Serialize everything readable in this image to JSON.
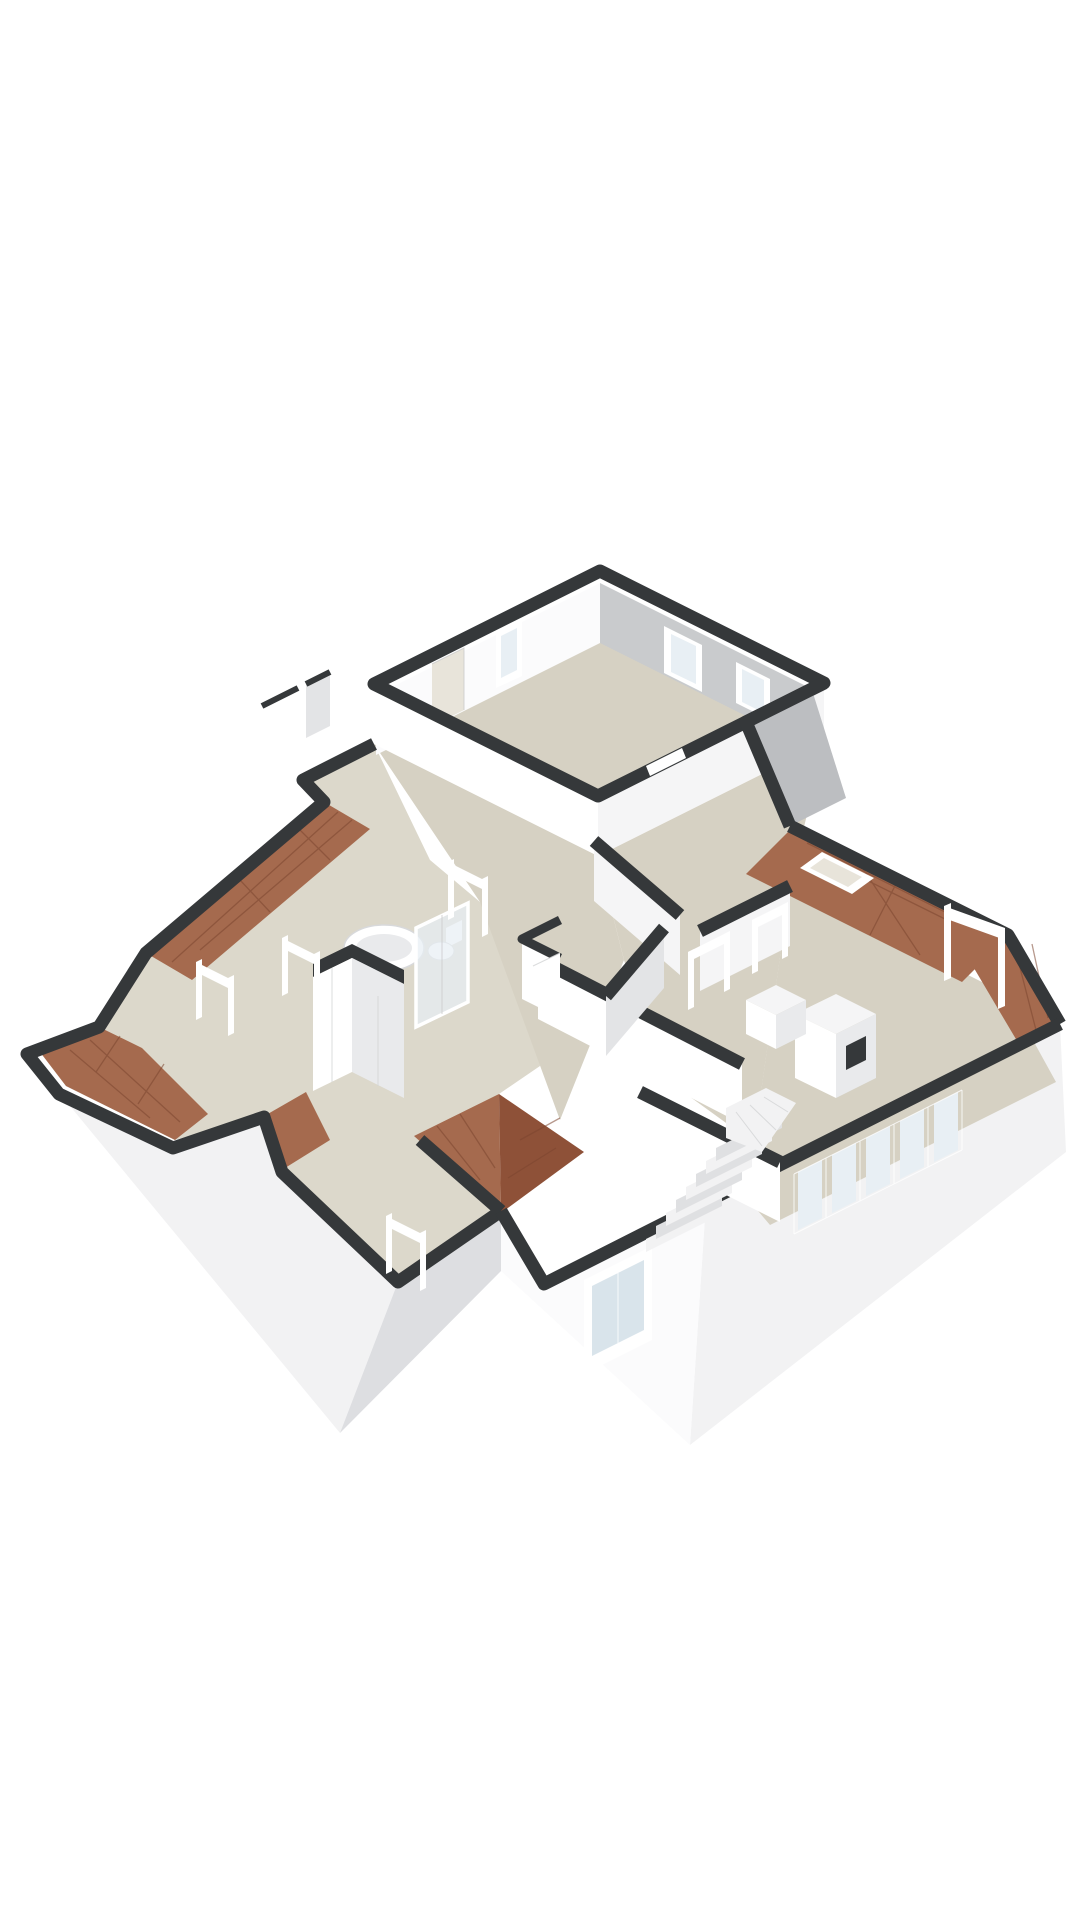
{
  "scene": {
    "type": "3d-floorplan-render",
    "view": "isometric",
    "storey": "attic floor with sloped roof sections",
    "background": "#ffffff"
  },
  "colors": {
    "wall_cap": "#35383a",
    "wall_cap_soft": "#45484a",
    "wall_white": "#ffffff",
    "wall_warm": "#fbfbfc",
    "wall_lit": "#f5f5f6",
    "wall_shade": "#e3e4e6",
    "wall_gray": "#c9cbcd",
    "wall_gray_deep": "#bcbec1",
    "ext_white": "#f2f2f3",
    "ext_shade": "#dddee1",
    "ext_shade_deep": "#d0d2d5",
    "floor": "#d6d1c3",
    "floor_light": "#dcd8cb",
    "floor_opening": "#e8e4da",
    "roof": "#a56a4e",
    "roof_dark": "#8e5138",
    "roof_line": "#7c452f",
    "glass": "#e8eff4",
    "glass_deep": "#d9e4eb",
    "frame": "#ffffff",
    "frame_line": "#c9c9cb",
    "fixture": "#ffffff",
    "fixture_shade": "#e9eaec",
    "fixture_line": "#d2d3d5",
    "step": "#f2f2f3",
    "step_shade": "#dfe0e2"
  },
  "objects": {
    "bedroom_large": "large room, top",
    "bedroom_right": "room with sloped roof edge, right",
    "bathroom": "bathtub, shower cabin, toilet, washbasin",
    "staircase": "winder staircase, bottom right",
    "wardrobe": "angled wardrobe block, centre left",
    "chimney": "chimney block with vent slot",
    "skylight": "roof window in tiled slope",
    "window_band": "five-part window band, lower right wall",
    "roof_sections": "terracotta tiled slope strips and centre gable"
  }
}
